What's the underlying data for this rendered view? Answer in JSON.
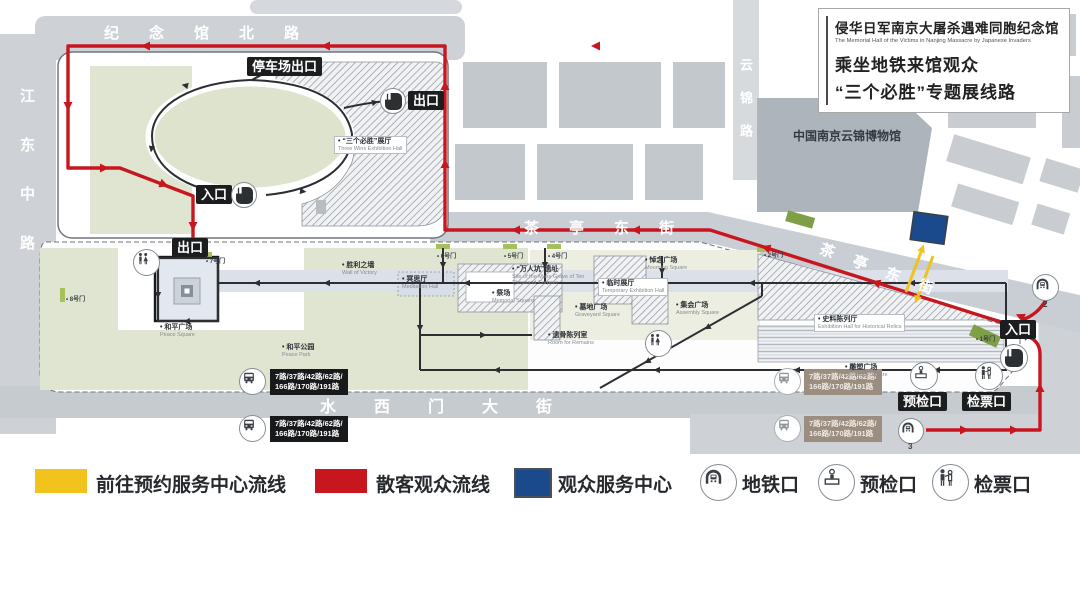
{
  "header": {
    "hall_zh": "侵华日军南京大屠杀遇难同胞纪念馆",
    "hall_en": "The Memorial Hall of the Victims in Nanjing Massacre by Japanese Invaders",
    "route_line1": "乘坐地铁来馆观众",
    "route_line2": "“三个必胜”专题展线路"
  },
  "roads": {
    "north": "纪念馆北路",
    "west": "江东中路",
    "south": "水西门大街",
    "east": "云锦路",
    "chating_h": "茶亭东街",
    "chating_d": "茶亭东街"
  },
  "buildings": {
    "yunjin": "中国南京云锦博物馆"
  },
  "signs": {
    "parking_exit": "停车场出口",
    "exit1": "出口",
    "entrance1": "入口",
    "exit2": "出口",
    "entrance3": "入口",
    "precheck": "预检口",
    "ticket": "检票口"
  },
  "metro": {
    "exit2": "2",
    "exit3": "3"
  },
  "bus": {
    "line1": "7路/37路/42路/62路/",
    "line2": "166路/170路/191路"
  },
  "places": {
    "three_wins": {
      "zh": "“三个必胜”展厅",
      "en": "Three Wins Exhibition Hall"
    },
    "peace_square": {
      "zh": "和平广场",
      "en": "Peace Square"
    },
    "peace_park": {
      "zh": "和平公园",
      "en": "Peace Park"
    },
    "victory_wall": {
      "zh": "胜利之墙",
      "en": "Wall of Victory"
    },
    "meditation": {
      "zh": "冥思厅",
      "en": "Meditation Hall"
    },
    "memorial_square": {
      "zh": "祭场",
      "en": "Memorial Square"
    },
    "mass_grave": {
      "zh": "“万人坑”遗址",
      "en": "Site of the Mass Grave of Ten Thousand Corpses"
    },
    "mourning": {
      "zh": "悼念广场",
      "en": "Mourning Square"
    },
    "temp_hall": {
      "zh": "临时展厅",
      "en": "Temporary Exhibition Hall"
    },
    "graveyard": {
      "zh": "墓地广场",
      "en": "Graveyard Square"
    },
    "bones": {
      "zh": "遗骨陈列室",
      "en": "Room for Remains"
    },
    "assembly": {
      "zh": "集会广场",
      "en": "Assembly Square"
    },
    "history_hall": {
      "zh": "史料陈列厅",
      "en": "Exhibition Hall for Historical Relics"
    },
    "sculpture": {
      "zh": "雕塑广场",
      "en": "Sculpture Square"
    }
  },
  "gates": {
    "g1": "1号门",
    "g2": "2号门",
    "g4": "4号门",
    "g5": "5号门",
    "g6": "6号门",
    "g7": "7号门",
    "g8": "8号门"
  },
  "legend": {
    "items": [
      {
        "label": "前往预约服务中心流线",
        "color": "#F2C31C"
      },
      {
        "label": "散客观众流线",
        "color": "#C8161E"
      },
      {
        "label": "观众服务中心",
        "color": "#1B4A8C"
      },
      {
        "label": "地铁口",
        "icon": "metro-icon"
      },
      {
        "label": "预检口",
        "icon": "precheck-icon"
      },
      {
        "label": "检票口",
        "icon": "ticket-icon"
      }
    ]
  },
  "colors": {
    "visitor_route": "#C8161E",
    "reservation_route": "#F2C31C",
    "service_center": "#1B4A8C",
    "road": "#CBD0D5",
    "park_green": "#DFE4D1"
  }
}
